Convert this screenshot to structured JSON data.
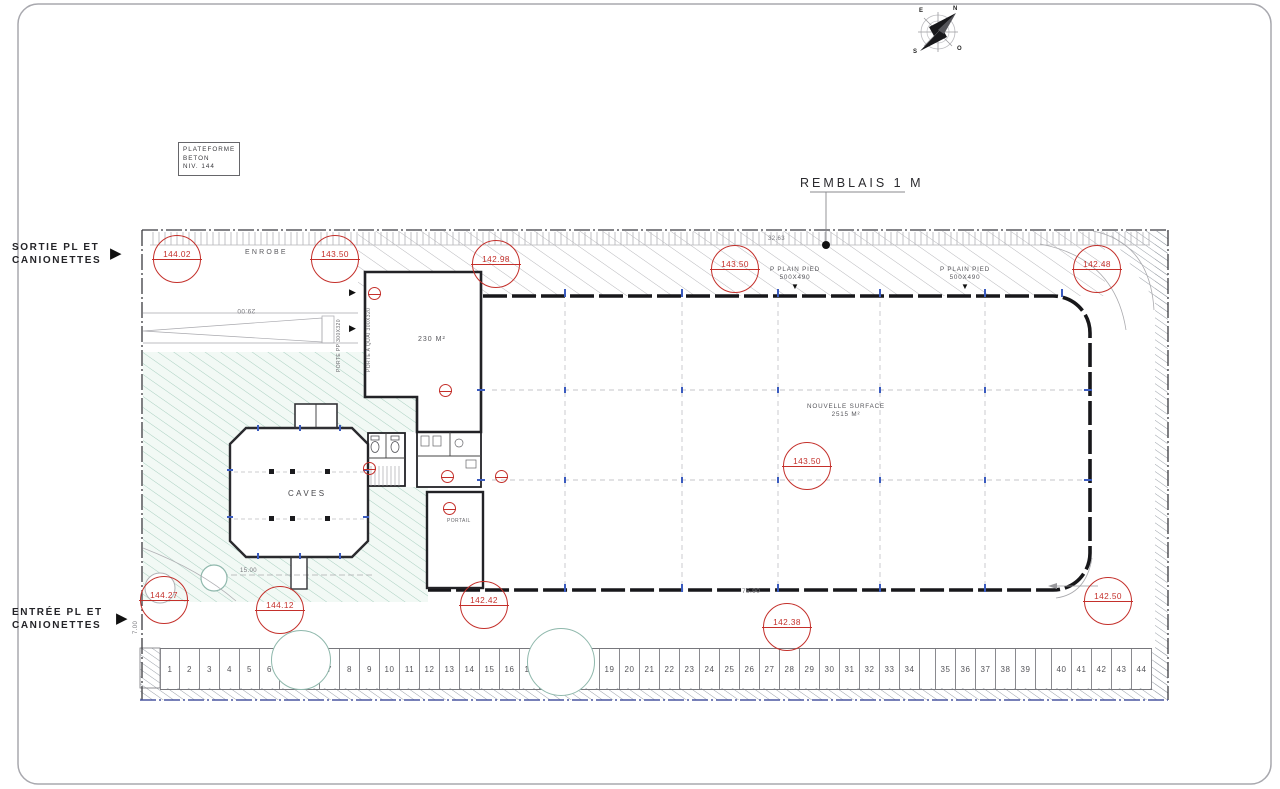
{
  "annotations": {
    "plateforme": {
      "line1": "PLATEFORME",
      "line2": "BETON",
      "line3": "NIV. 144"
    },
    "remblais": "REMBLAIS  1 M",
    "enrobe": "ENROBE",
    "sortie": {
      "line1": "SORTIE PL ET",
      "line2": "CANIONETTES"
    },
    "entree": {
      "line1": "ENTRÉE PL ET",
      "line2": "CANIONETTES"
    },
    "plain_pied_left": {
      "line1": "P PLAIN PIED",
      "line2": "500X490"
    },
    "plain_pied_right": {
      "line1": "P PLAIN PIED",
      "line2": "500X490"
    },
    "annex_area": "230 M²",
    "hall": {
      "line1": "NOUVELLE SURFACE",
      "line2": "2515 M²"
    },
    "caves": "CAVES",
    "portail": "PORTAIL",
    "porte_pp": "PORTE PP 300X320",
    "porte_quai": "PORTE A QUAI 300X320"
  },
  "dimensions": {
    "top_setback": "32.63",
    "hall_width": "75.90",
    "ramp_length": "29.00",
    "caves_length": "15.00",
    "entry_width": "7.00"
  },
  "compass": {
    "top_left": "E",
    "top_right": "N",
    "bottom_right": "O",
    "bottom_left": "S"
  },
  "markers": [
    {
      "value": "144.02",
      "x": 176,
      "y": 258
    },
    {
      "value": "143.50",
      "x": 334,
      "y": 258
    },
    {
      "value": "142.98",
      "x": 495,
      "y": 263
    },
    {
      "value": "143.50",
      "x": 734,
      "y": 268
    },
    {
      "value": "142.48",
      "x": 1096,
      "y": 268
    },
    {
      "value": "143.50",
      "x": 806,
      "y": 465
    },
    {
      "value": "144.27",
      "x": 163,
      "y": 599
    },
    {
      "value": "144.12",
      "x": 279,
      "y": 609
    },
    {
      "value": "142.42",
      "x": 483,
      "y": 604
    },
    {
      "value": "142.38",
      "x": 786,
      "y": 626
    },
    {
      "value": "142.50",
      "x": 1107,
      "y": 600
    }
  ],
  "parking": {
    "sequence": [
      "1",
      "2",
      "3",
      "4",
      "5",
      "6",
      "TREE",
      "7",
      "8",
      "9",
      "10",
      "11",
      "12",
      "13",
      "14",
      "15",
      "16",
      "17",
      "TREE",
      "18",
      "19",
      "20",
      "21",
      "22",
      "23",
      "24",
      "25",
      "26",
      "27",
      "28",
      "29",
      "30",
      "31",
      "32",
      "33",
      "34",
      "GAP",
      "35",
      "36",
      "37",
      "38",
      "39",
      "GAP",
      "40",
      "41",
      "42",
      "43",
      "44"
    ]
  },
  "colors": {
    "marker_red": "#c4302b",
    "green_hatch": "#a9cfc0",
    "tick_blue": "#3a5bbf",
    "wall": "#1c1c1e"
  }
}
